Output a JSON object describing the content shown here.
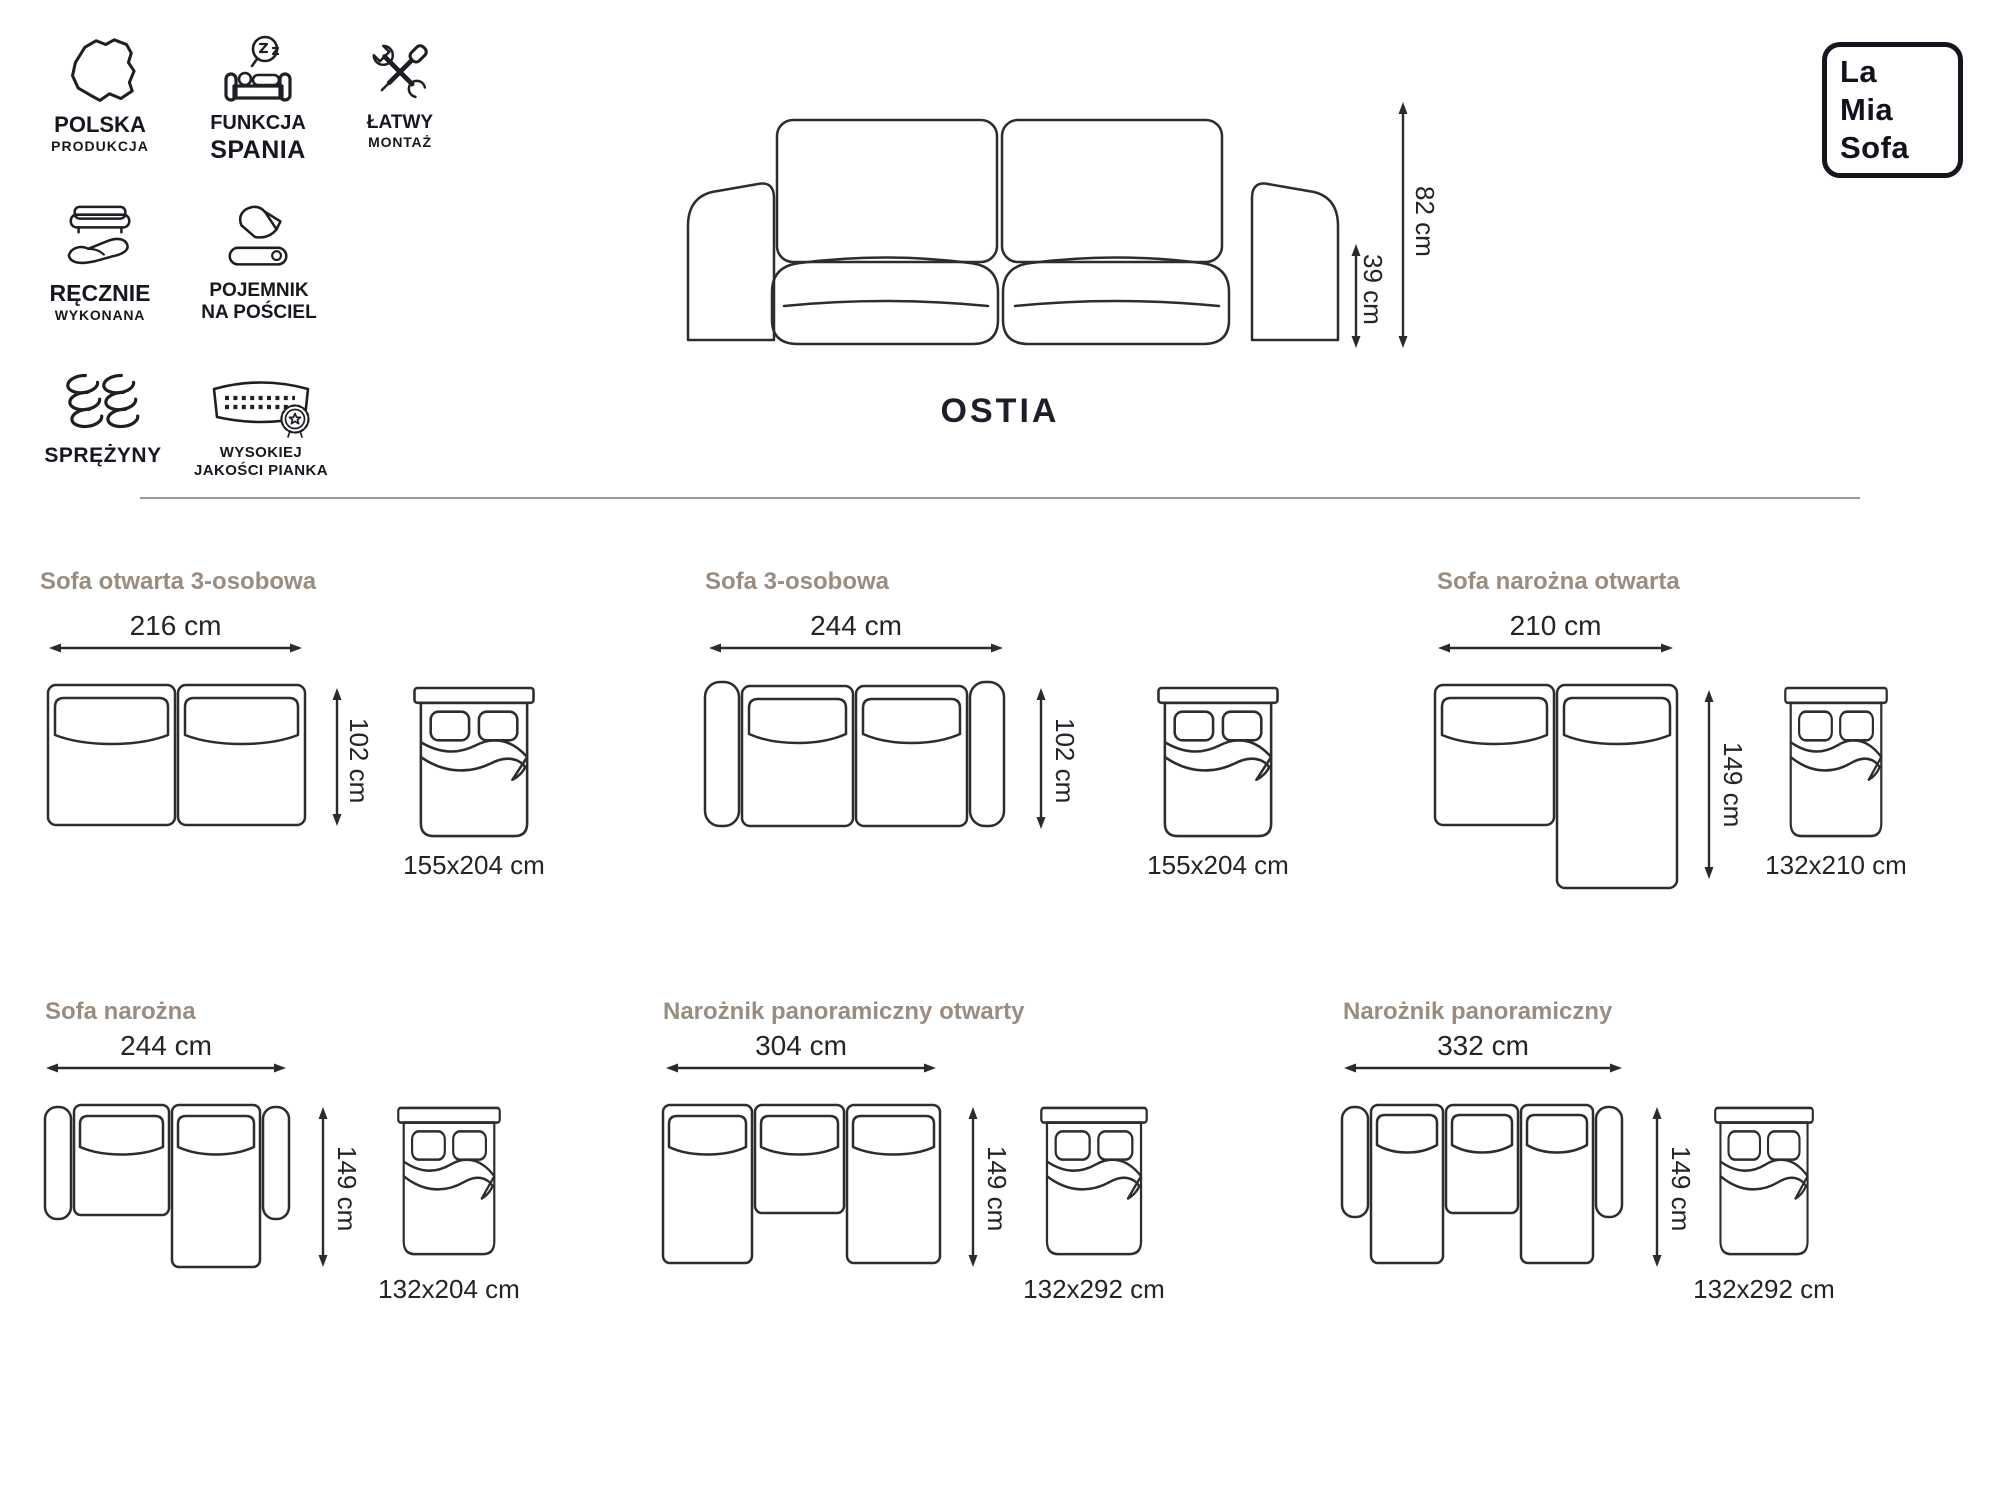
{
  "brand": {
    "name": "La Mia Sofa",
    "line1": "La",
    "line2": "Mia",
    "line3": "Sofa"
  },
  "product": {
    "name": "OSTIA",
    "total_height": "82 cm",
    "seat_height": "39 cm"
  },
  "features": [
    {
      "icon": "poland-map",
      "line1": "POLSKA",
      "line2": "PRODUKCJA"
    },
    {
      "icon": "sofa-sleep",
      "line1": "FUNKCJA",
      "line2": "SPANIA"
    },
    {
      "icon": "tools",
      "line1": "ŁATWY",
      "line2": "MONTAŻ"
    },
    {
      "icon": "hand-sofa",
      "line1": "RĘCZNIE",
      "line2": "WYKONANA"
    },
    {
      "icon": "bedding",
      "line1": "POJEMNIK",
      "line2": "NA POŚCIEL"
    },
    {
      "icon": "springs",
      "line1": "SPRĘŻYNY",
      "line2": ""
    },
    {
      "icon": "foam-badge",
      "line1": "WYSOKIEJ",
      "line2": "JAKOŚCI PIANKA"
    }
  ],
  "configurations": [
    {
      "title": "Sofa otwarta 3-osobowa",
      "width": "216 cm",
      "depth": "102 cm",
      "bed": "155x204 cm"
    },
    {
      "title": "Sofa 3-osobowa",
      "width": "244 cm",
      "depth": "102 cm",
      "bed": "155x204 cm"
    },
    {
      "title": "Sofa narożna otwarta",
      "width": "210 cm",
      "depth": "149 cm",
      "bed": "132x210 cm"
    },
    {
      "title": "Sofa narożna",
      "width": "244 cm",
      "depth": "149 cm",
      "bed": "132x204 cm"
    },
    {
      "title": "Narożnik panoramiczny otwarty",
      "width": "304 cm",
      "depth": "149 cm",
      "bed": "132x292 cm"
    },
    {
      "title": "Narożnik panoramiczny",
      "width": "332 cm",
      "depth": "149 cm",
      "bed": "132x292 cm"
    }
  ],
  "colors": {
    "accent_title": "#9b8c80",
    "line": "#2c2c31",
    "text": "#23232a"
  }
}
